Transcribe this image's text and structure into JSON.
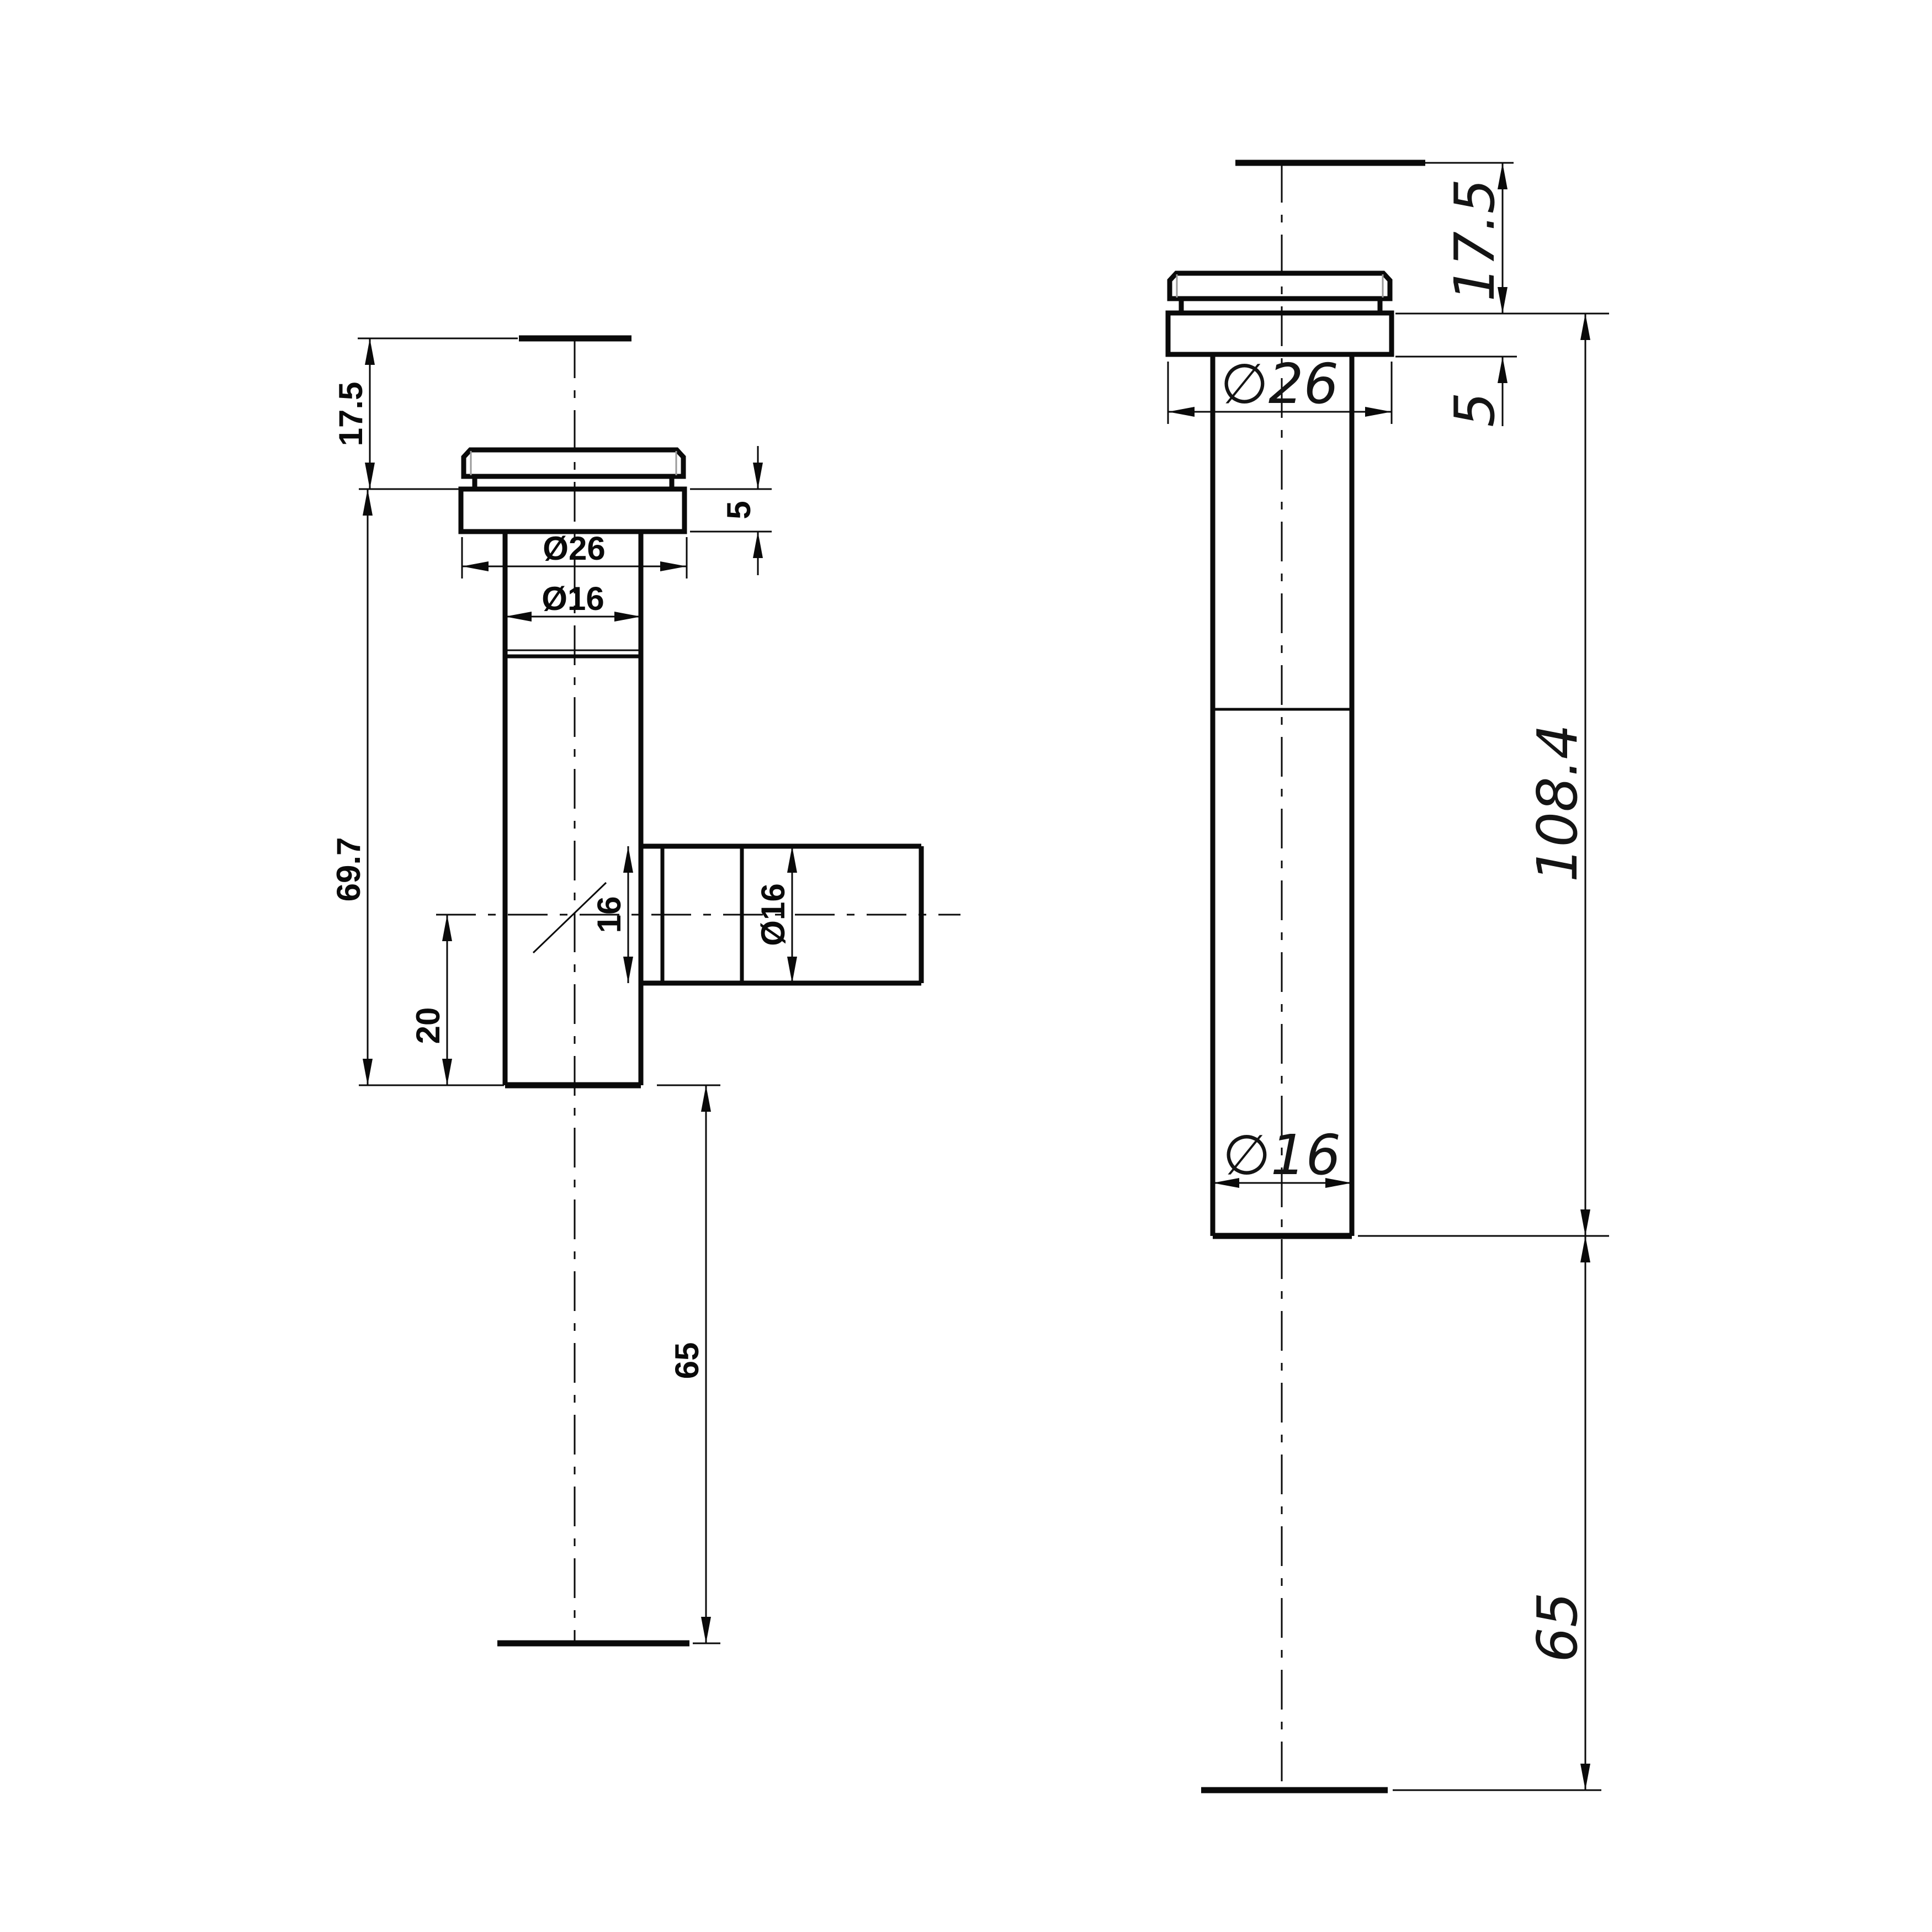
{
  "drawing": {
    "kind": "2D CAD dimension drawing, two orthographic views of a tubular glass-mount fitting",
    "background_color": "#ffffff",
    "line_color": "#0a0a0a",
    "chamfer_edge_color": "#9a9a9a"
  },
  "left_view": {
    "name": "front view with side outlet",
    "dims": {
      "top_offset": "17.5",
      "flange_thickness": "5",
      "flange_dia": "Ø26",
      "tube_dia": "Ø16",
      "body_height": "69.7",
      "bore_width": "16",
      "branch_dia": "Ø16",
      "branch_offset": "20",
      "bottom_extension": "65"
    }
  },
  "right_view": {
    "name": "side view",
    "dims": {
      "top_offset": "17.5",
      "flange_thickness": "5",
      "flange_dia": "∅26",
      "tube_dia": "∅16",
      "overall_height": "108.4",
      "bottom_extension": "65"
    }
  }
}
